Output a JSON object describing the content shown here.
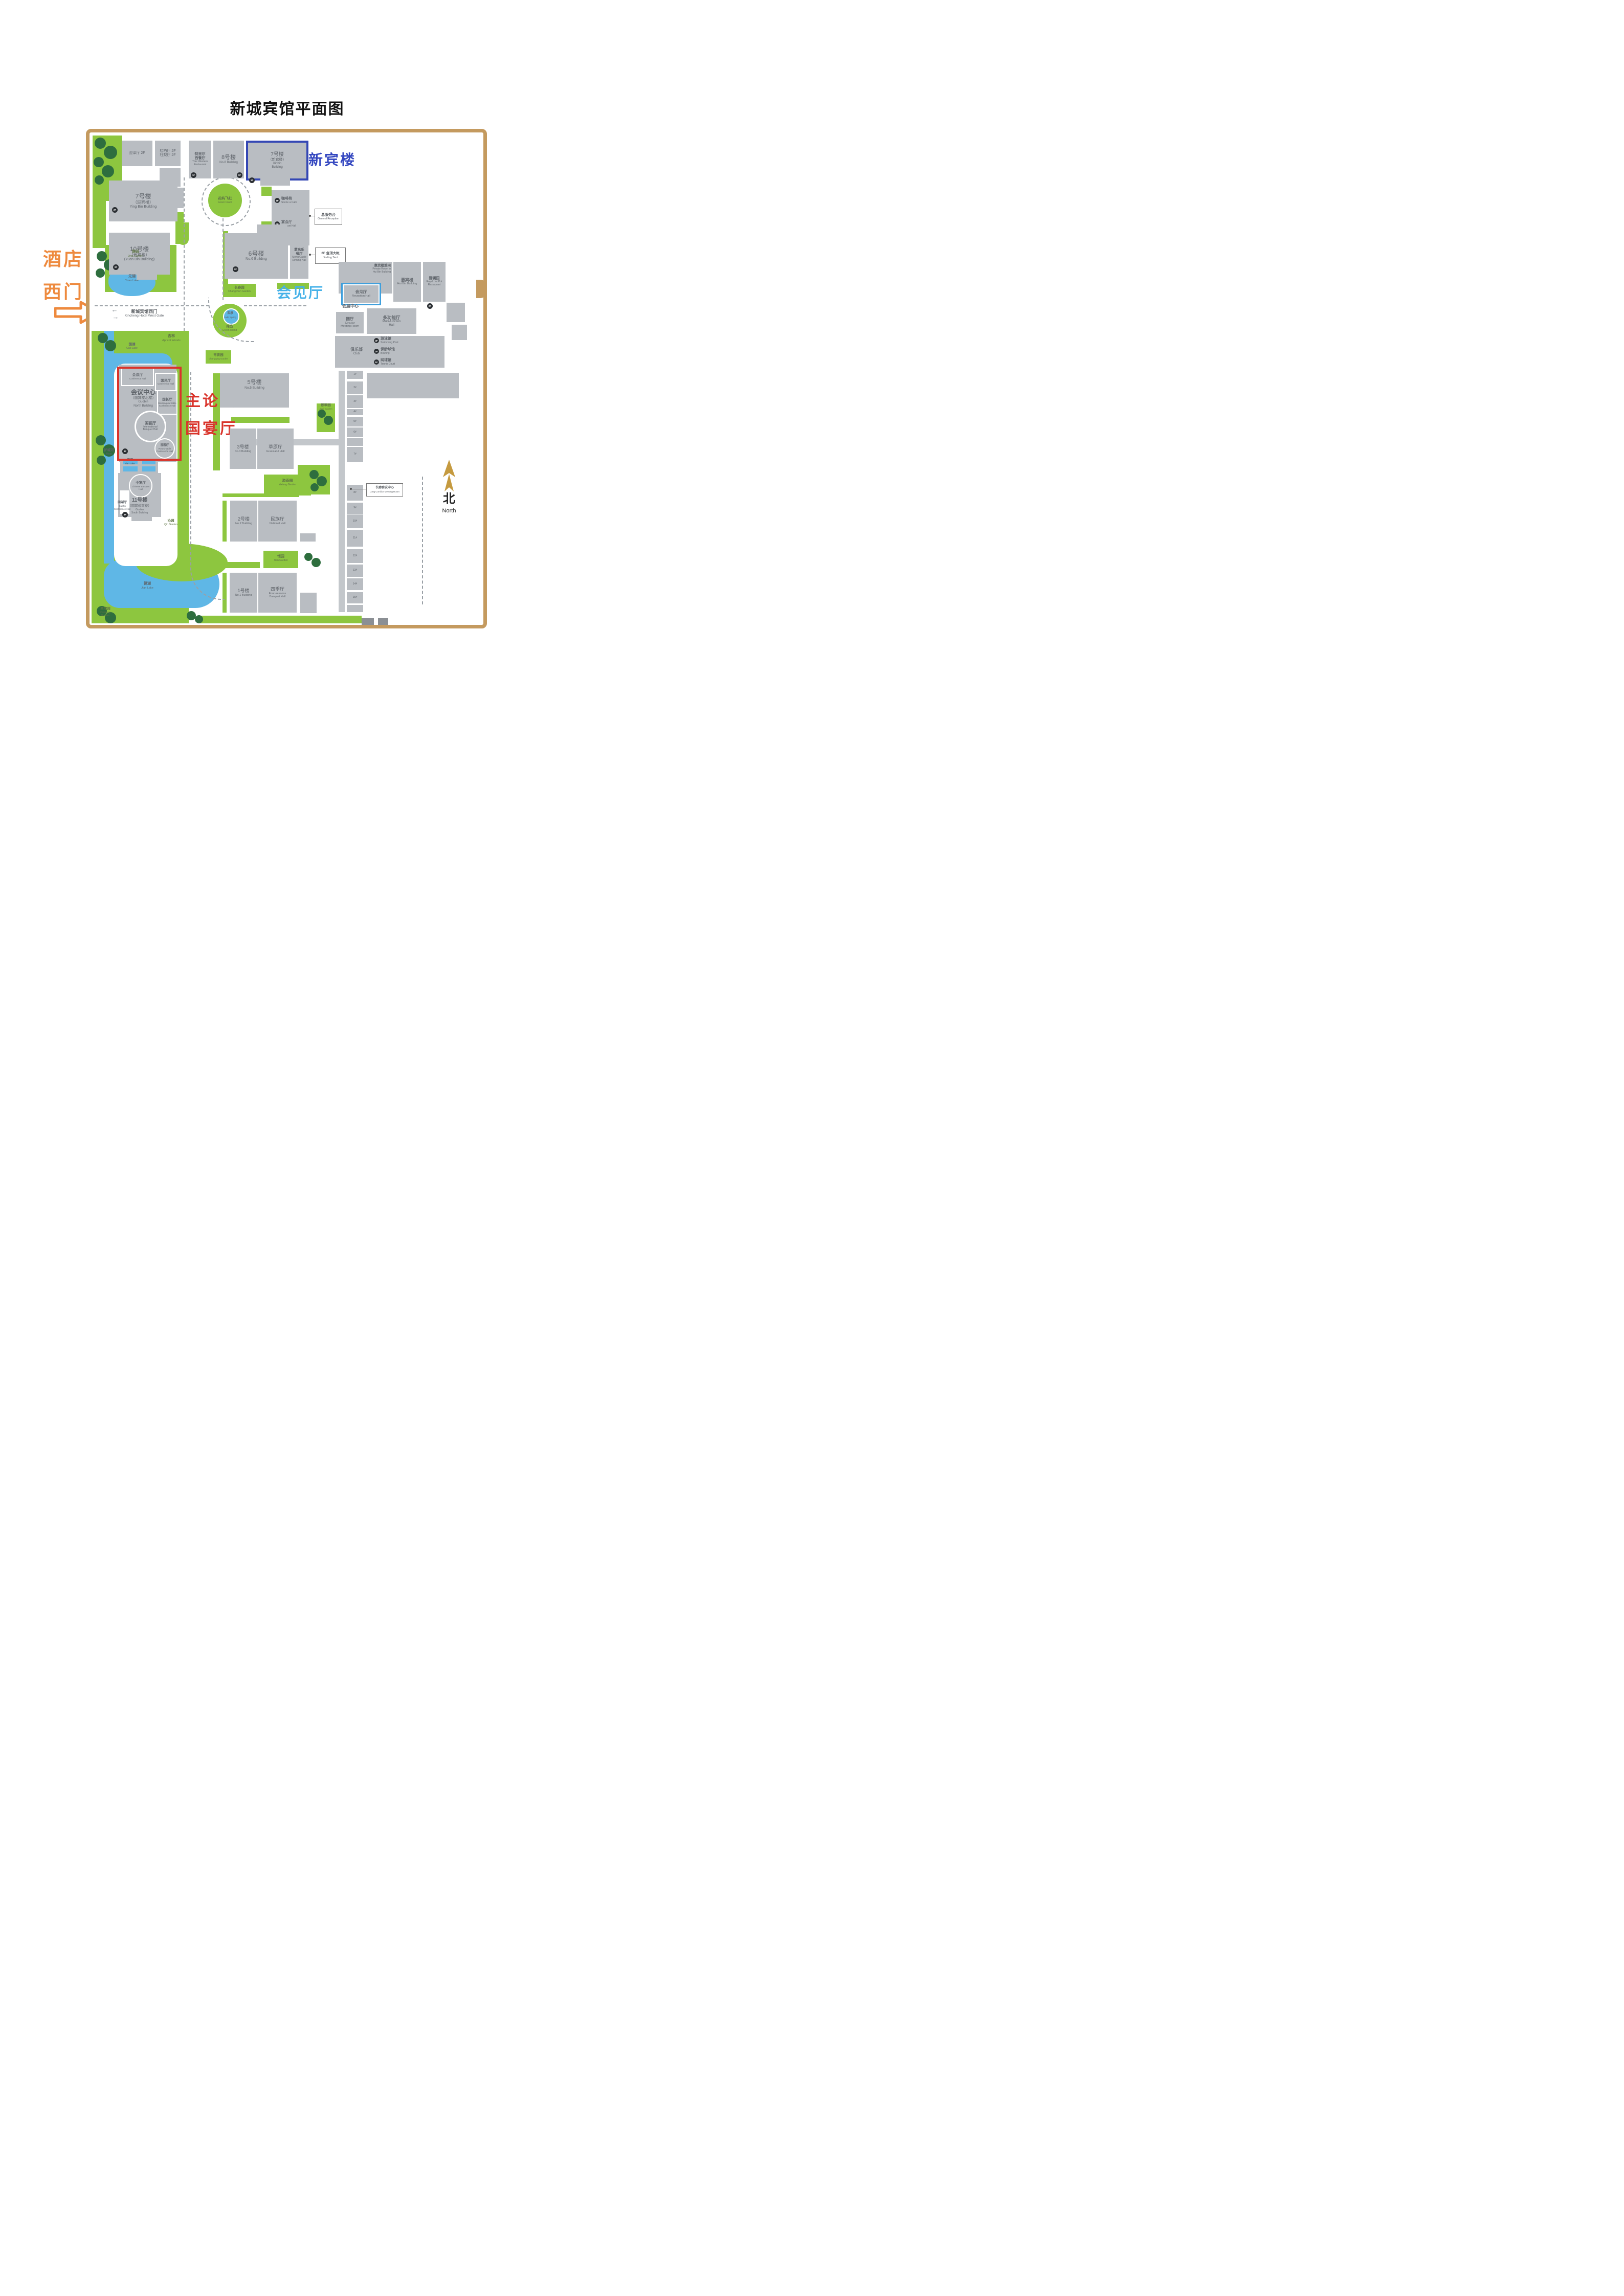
{
  "title": "新城宾馆平面图",
  "west_gate": {
    "big1": "酒店",
    "big2": "西门",
    "zh": "新城宾馆西门",
    "en": "Xincheng Hotel West Gate",
    "arrow_left": "←",
    "arrow_right": "→"
  },
  "annotations": {
    "xinbin": "新宾楼",
    "reception": "会见厅",
    "forum1": "主论坛",
    "forum2": "国宴厅"
  },
  "north": {
    "zh": "北",
    "en": "North"
  },
  "buildings": {
    "yingze": {
      "zh": "迎泽厅 2F"
    },
    "guibai": {
      "zh1": "桧柏厅 2F",
      "zh2": "杜梨厅 2F"
    },
    "trier": {
      "zh1": "特里尔",
      "zh2": "西餐厅",
      "en1": "Trier Western",
      "en2": "Restaurant",
      "badge": "1F"
    },
    "no8": {
      "zh": "8号楼",
      "en": "No.8 Building",
      "badge": "9F"
    },
    "no7xinbin": {
      "zh": "7号楼",
      "zh2": "（新宾楼）",
      "en1": "Xinbin",
      "en2": "Building",
      "badge": "1F"
    },
    "no7yingbin": {
      "zh": "7号楼",
      "zh2": "（迎宾楼）",
      "en": "Ying Bin Building",
      "badge": "2F"
    },
    "no10": {
      "zh": "10号楼",
      "zh2": "（元宾楼）",
      "en": "(Yuan Bin Building)",
      "badge": "2F"
    },
    "cafe": {
      "zh": "咖啡苑",
      "en": "Scene a Cafe",
      "badge": "1F"
    },
    "banquet": {
      "zh": "宴会厅",
      "en": "Banquet Hall",
      "badge": "2F"
    },
    "no6": {
      "zh": "6号楼",
      "en": "No.6 Building",
      "badge": "2F"
    },
    "menggaole": {
      "zh1": "蒙高乐",
      "zh2": "餐厅",
      "en1": "Meng Gaole",
      "en2": "Dinning Hall"
    },
    "huibin_private": {
      "zh": "惠宾楼雅间",
      "en1": "Private Room in",
      "en2": "Hui Bin Building"
    },
    "reception_hall": {
      "zh": "会见厅",
      "en": "Reception Hall"
    },
    "huibin": {
      "zh": "惠宾楼",
      "en": "Hui Bin Building"
    },
    "royal": {
      "zh": "御澜园",
      "en1": "Royal Hot Pot",
      "en2": "Restaurant",
      "badge": "2F"
    },
    "exhibition": {
      "zh": "会展中心"
    },
    "circular": {
      "zh": "圆厅",
      "en1": "Circular",
      "en2": "Meeting Room"
    },
    "multifunction": {
      "zh": "多功能厅",
      "en1": "Multi-function",
      "en2": "Hall"
    },
    "club": {
      "zh": "俱乐部",
      "en": "Club"
    },
    "swimming": {
      "zh": "游泳馆",
      "en": "Swimming Pool",
      "badge": "3F"
    },
    "bowling": {
      "zh": "保龄球馆",
      "en": "Bowling",
      "badge": "2F"
    },
    "tennis": {
      "zh": "网球馆",
      "en": "Tennis Court",
      "badge": "1F"
    },
    "no5": {
      "zh": "5号楼",
      "en": "No.5 Building"
    },
    "no3": {
      "zh": "3号楼",
      "en": "No.3 Building"
    },
    "grassland": {
      "zh": "草原厅",
      "en": "Grassland Hall"
    },
    "no2": {
      "zh": "2号楼",
      "en": "No.2 Building"
    },
    "national": {
      "zh": "民族厅",
      "en": "National Hall"
    },
    "no1": {
      "zh": "1号楼",
      "en": "No.1 Building"
    },
    "fourseasons": {
      "zh": "四季厅",
      "en1": "Four-seasons",
      "en2": "Banquet Hall"
    },
    "conference_hall": {
      "zh": "会议厅",
      "en": "Conference Hall"
    },
    "guojian": {
      "zh": "国见厅",
      "en": "Conference Hall"
    },
    "center": {
      "zh": "会议中心",
      "zh2": "（国宾楼北楼）",
      "en1": "Guobin",
      "en2": "North Building",
      "badge": "3F"
    },
    "guochang": {
      "zh": "国长厅",
      "en1": "Rectangular-table",
      "en2": "Conference Hall"
    },
    "guoyan": {
      "zh": "国宴厅",
      "en1": "International",
      "en2": "Banquet Hall"
    },
    "guoyuan": {
      "zh": "国圆厅",
      "en1": "Round-table",
      "en2": "Conference Hall"
    },
    "zhongyan": {
      "zh": "中宴厅",
      "en1": "Chinese Banquet",
      "en2": "Hall"
    },
    "no11": {
      "zh": "11号楼",
      "zh2": "（国宾楼南楼）",
      "en1": "Guobin",
      "en2": "South Building",
      "badge": "3F"
    },
    "guohu_hall": {
      "zh": "国湖厅",
      "en1": "Guohu",
      "en2": "Conference Hall"
    }
  },
  "callouts": {
    "reception_desk": {
      "zh": "总服务台",
      "en": "General Reception"
    },
    "jinding": {
      "zh": "2F 金顶大帐",
      "en": "Jinding Tent"
    },
    "corridor": {
      "zh": "长廊会议中心",
      "en": "Long Corridor Meeting Room"
    }
  },
  "gardens": {
    "jing": {
      "zh": "静园",
      "en": "Jing Garden"
    },
    "changchun": {
      "zh": "长春园",
      "en": "Changchun Garden"
    },
    "huayu": {
      "zh": "花屿飞红",
      "en": "Green Island"
    },
    "apricot": {
      "zh": "杏林",
      "en": "Apricot Woods"
    },
    "changqing": {
      "zh": "常青园",
      "en": "Changqing Garden"
    },
    "lvdao": {
      "zh": "绿岛",
      "en": "Green Island"
    },
    "jicui": {
      "zh": "积翠园",
      "en": "Jicui Garden"
    },
    "yixiang": {
      "zh": "溢香园",
      "en": "Yixiang Garden"
    },
    "tian": {
      "zh": "恬园",
      "en": "Tian Garden"
    },
    "qin": {
      "zh": "沁园",
      "en": "Qin Garden"
    },
    "cuiqiong": {
      "zh": "翠穹园",
      "en1": "Cuiqiong",
      "en2": "Garden"
    }
  },
  "waters": {
    "yuan": {
      "zh": "元湖",
      "en": "Yuan Lake"
    },
    "jade": {
      "zh": "玉泉",
      "en": "Jade Spring"
    },
    "guo": {
      "zh": "国湖",
      "en": "Guo Lake"
    },
    "moat": {
      "zh": "护城河",
      "en": "Moat"
    },
    "tianlake": {
      "zh": "天湖",
      "en": "Tian Lake"
    },
    "jian": {
      "zh": "健湖",
      "en": "Jian Lake"
    }
  },
  "column": [
    "1#",
    "2#",
    "3#",
    "4#",
    "5#",
    "6#",
    "7#",
    "8#",
    "9#",
    "10#",
    "11#",
    "12#",
    "13#",
    "14#",
    "15#"
  ],
  "colors": {
    "accent_blue": "#3447b4",
    "accent_cyan": "#45b1e8",
    "accent_red": "#d9342b",
    "accent_orange": "#ee8a3e",
    "frame": "#c49a5f",
    "building": "#b9bdc2",
    "garden": "#8dc63f",
    "tree": "#2e6e3e",
    "water": "#5fb7e6"
  }
}
